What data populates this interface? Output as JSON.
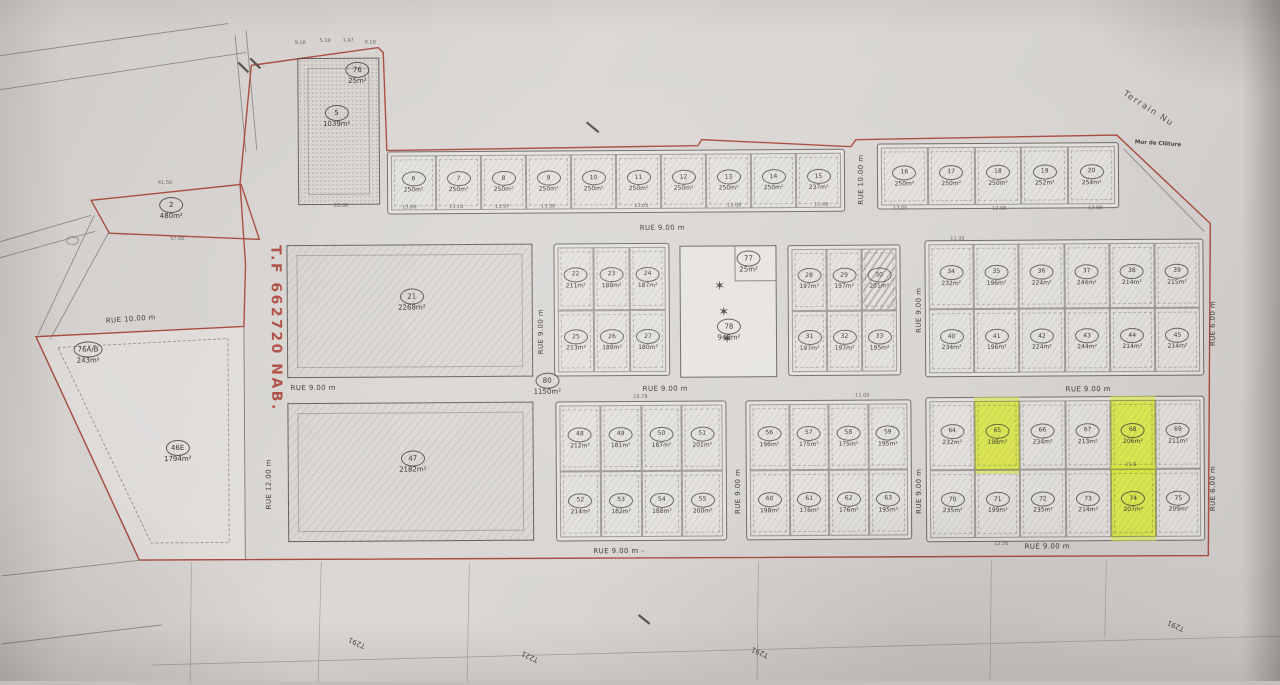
{
  "colors": {
    "paper": "#d6d3d0",
    "boundary_red": "#a84a3e",
    "highlight": "#d7e537",
    "line": "#5f5c59"
  },
  "annotations": {
    "tf_number": "T.F 662720 NAB.",
    "terrain_nu": "Terrain Nu",
    "mur_cloture": "Mur de Clôture"
  },
  "edge_labels": [
    {
      "text": "T291",
      "x": 355,
      "y": 641,
      "rot": 205
    },
    {
      "text": "T221",
      "x": 528,
      "y": 656,
      "rot": 205
    },
    {
      "text": "T291",
      "x": 758,
      "y": 653,
      "rot": 203
    },
    {
      "text": "T291",
      "x": 1174,
      "y": 629,
      "rot": 205
    }
  ],
  "street_labels": [
    {
      "text": "RUE 9.00 m",
      "x": 663,
      "y": 228,
      "rot": 0
    },
    {
      "text": "RUE 9.00 m",
      "x": 313,
      "y": 386,
      "rot": 0
    },
    {
      "text": "RUE 9.00 m",
      "x": 665,
      "y": 389,
      "rot": 0
    },
    {
      "text": "RUE 9.00 m",
      "x": 1088,
      "y": 392,
      "rot": 0
    },
    {
      "text": "RUE 9.00 m  –",
      "x": 618,
      "y": 551,
      "rot": 0
    },
    {
      "text": "RUE 9.00 m",
      "x": 1046,
      "y": 549,
      "rot": 0
    },
    {
      "text": "RUE 10.00 m",
      "x": 862,
      "y": 181,
      "rot": -90
    },
    {
      "text": "RUE 9.00 m",
      "x": 541,
      "y": 331,
      "rot": -90
    },
    {
      "text": "RUE 9.00 m",
      "x": 919,
      "y": 312,
      "rot": -90
    },
    {
      "text": "RUE 9.00 m",
      "x": 737,
      "y": 492,
      "rot": -90
    },
    {
      "text": "RUE 9.00 m",
      "x": 918,
      "y": 493,
      "rot": -90
    },
    {
      "text": "RUE 6.00 m",
      "x": 1213,
      "y": 327,
      "rot": -90
    },
    {
      "text": "RUE 6.00 m",
      "x": 1212,
      "y": 492,
      "rot": -90
    },
    {
      "text": "RUE 12.00 m",
      "x": 268,
      "y": 482,
      "rot": -90
    },
    {
      "text": "RUE 10.00 m",
      "x": 131,
      "y": 316,
      "rot": -4
    }
  ],
  "large_parcels": [
    {
      "num": "2",
      "area": "480m²",
      "x": 172,
      "y": 206
    },
    {
      "num": "5",
      "area": "1039m²",
      "x": 338,
      "y": 115
    },
    {
      "num": "76",
      "area": "25m²",
      "x": 359,
      "y": 72
    },
    {
      "num": "76A/B",
      "area": "243m²",
      "x": 88,
      "y": 350
    },
    {
      "num": "21",
      "area": "2268m²",
      "x": 412,
      "y": 299
    },
    {
      "num": "47",
      "area": "2182m²",
      "x": 412,
      "y": 461
    },
    {
      "num": "46E",
      "area": "1794m²",
      "x": 177,
      "y": 449
    },
    {
      "num": "77",
      "area": "25m²",
      "x": 749,
      "y": 263
    },
    {
      "num": "78",
      "area": "948m²",
      "x": 729,
      "y": 331
    },
    {
      "num": "80",
      "area": "1150m²",
      "x": 547,
      "y": 384
    }
  ],
  "green_area": {
    "stars": [
      {
        "x": 720,
        "y": 287
      },
      {
        "x": 724,
        "y": 313
      },
      {
        "x": 727,
        "y": 340
      }
    ]
  },
  "blocks": [
    {
      "name": "top-strip-west",
      "x": 388,
      "y": 150,
      "w": 458,
      "h": 63,
      "cols": 10,
      "lots": [
        {
          "num": "6",
          "area": "250m²"
        },
        {
          "num": "7",
          "area": "250m²"
        },
        {
          "num": "8",
          "area": "250m²"
        },
        {
          "num": "9",
          "area": "250m²"
        },
        {
          "num": "10",
          "area": "250m²"
        },
        {
          "num": "11",
          "area": "250m²"
        },
        {
          "num": "12",
          "area": "250m²"
        },
        {
          "num": "13",
          "area": "250m²"
        },
        {
          "num": "14",
          "area": "250m²"
        },
        {
          "num": "15",
          "area": "237m²"
        }
      ]
    },
    {
      "name": "top-strip-east",
      "x": 878,
      "y": 145,
      "w": 242,
      "h": 66,
      "cols": 5,
      "lots": [
        {
          "num": "16",
          "area": "250m²"
        },
        {
          "num": "17",
          "area": "250m²"
        },
        {
          "num": "18",
          "area": "250m²"
        },
        {
          "num": "19",
          "area": "252m²"
        },
        {
          "num": "20",
          "area": "254m²"
        }
      ]
    },
    {
      "name": "block-22-27",
      "x": 554,
      "y": 243,
      "w": 116,
      "h": 133,
      "cols": 3,
      "lots": [
        {
          "num": "22",
          "area": "211m²"
        },
        {
          "num": "23",
          "area": "188m²"
        },
        {
          "num": "24",
          "area": "187m²"
        },
        {
          "num": "25",
          "area": "213m²"
        },
        {
          "num": "26",
          "area": "188m²"
        },
        {
          "num": "27",
          "area": "180m²"
        }
      ]
    },
    {
      "name": "block-28-33",
      "x": 788,
      "y": 246,
      "w": 113,
      "h": 131,
      "cols": 3,
      "lots": [
        {
          "num": "28",
          "area": "197m²"
        },
        {
          "num": "29",
          "area": "197m²"
        },
        {
          "num": "30",
          "area": "201m²",
          "striped": true
        },
        {
          "num": "31",
          "area": "197m²"
        },
        {
          "num": "32",
          "area": "197m²"
        },
        {
          "num": "33",
          "area": "195m²"
        }
      ]
    },
    {
      "name": "block-34-45",
      "x": 925,
      "y": 242,
      "w": 279,
      "h": 137,
      "cols": 6,
      "lots": [
        {
          "num": "34",
          "area": "232m²"
        },
        {
          "num": "35",
          "area": "196m²"
        },
        {
          "num": "36",
          "area": "224m²"
        },
        {
          "num": "37",
          "area": "244m²"
        },
        {
          "num": "38",
          "area": "214m²"
        },
        {
          "num": "39",
          "area": "215m²"
        },
        {
          "num": "40",
          "area": "234m²"
        },
        {
          "num": "41",
          "area": "196m²"
        },
        {
          "num": "42",
          "area": "224m²"
        },
        {
          "num": "43",
          "area": "244m²"
        },
        {
          "num": "44",
          "area": "214m²"
        },
        {
          "num": "45",
          "area": "214m²"
        }
      ]
    },
    {
      "name": "block-48-55",
      "x": 555,
      "y": 401,
      "w": 171,
      "h": 140,
      "cols": 4,
      "lots": [
        {
          "num": "48",
          "area": "212m²"
        },
        {
          "num": "49",
          "area": "181m²"
        },
        {
          "num": "50",
          "area": "187m²"
        },
        {
          "num": "51",
          "area": "201m²"
        },
        {
          "num": "52",
          "area": "214m²"
        },
        {
          "num": "53",
          "area": "182m²"
        },
        {
          "num": "54",
          "area": "188m²"
        },
        {
          "num": "55",
          "area": "200m²"
        }
      ]
    },
    {
      "name": "block-56-63",
      "x": 745,
      "y": 401,
      "w": 166,
      "h": 140,
      "cols": 4,
      "lots": [
        {
          "num": "56",
          "area": "196m²"
        },
        {
          "num": "57",
          "area": "175m²"
        },
        {
          "num": "58",
          "area": "175m²"
        },
        {
          "num": "59",
          "area": "195m²"
        },
        {
          "num": "60",
          "area": "198m²"
        },
        {
          "num": "61",
          "area": "176m²"
        },
        {
          "num": "62",
          "area": "176m²"
        },
        {
          "num": "63",
          "area": "195m²"
        }
      ]
    },
    {
      "name": "block-64-75",
      "x": 925,
      "y": 399,
      "w": 279,
      "h": 145,
      "cols": 6,
      "lots": [
        {
          "num": "64",
          "area": "232m²"
        },
        {
          "num": "65",
          "area": "198m²",
          "hl": true
        },
        {
          "num": "66",
          "area": "234m²"
        },
        {
          "num": "67",
          "area": "213m²"
        },
        {
          "num": "68",
          "area": "206m²",
          "hl": true
        },
        {
          "num": "69",
          "area": "211m²"
        },
        {
          "num": "70",
          "area": "235m²"
        },
        {
          "num": "71",
          "area": "199m²"
        },
        {
          "num": "72",
          "area": "235m²"
        },
        {
          "num": "73",
          "area": "214m²"
        },
        {
          "num": "74",
          "area": "207m²",
          "hl": true
        },
        {
          "num": "75",
          "area": "209m²"
        }
      ]
    }
  ],
  "dims": [
    {
      "t": "9.10",
      "x": 302,
      "y": 41
    },
    {
      "t": "5.10",
      "x": 327,
      "y": 39
    },
    {
      "t": "1.47",
      "x": 350,
      "y": 39
    },
    {
      "t": "9.10",
      "x": 372,
      "y": 41
    },
    {
      "t": "41.50",
      "x": 166,
      "y": 180
    },
    {
      "t": "57.00",
      "x": 178,
      "y": 236
    },
    {
      "t": "20.00",
      "x": 342,
      "y": 204
    },
    {
      "t": "13.08",
      "x": 410,
      "y": 206
    },
    {
      "t": "13.10",
      "x": 457,
      "y": 206
    },
    {
      "t": "13.97",
      "x": 503,
      "y": 206
    },
    {
      "t": "13.06",
      "x": 549,
      "y": 206
    },
    {
      "t": "13.05",
      "x": 642,
      "y": 206
    },
    {
      "t": "13.08",
      "x": 735,
      "y": 206
    },
    {
      "t": "11.46",
      "x": 822,
      "y": 206
    },
    {
      "t": "13.05",
      "x": 901,
      "y": 210
    },
    {
      "t": "12.08",
      "x": 1000,
      "y": 211
    },
    {
      "t": "12.08",
      "x": 1096,
      "y": 211
    },
    {
      "t": "11.35",
      "x": 958,
      "y": 241
    },
    {
      "t": "10.78",
      "x": 640,
      "y": 397
    },
    {
      "t": "11.00",
      "x": 862,
      "y": 397
    },
    {
      "t": "15.8",
      "x": 1130,
      "y": 468
    },
    {
      "t": "12.50",
      "x": 1000,
      "y": 546
    }
  ]
}
